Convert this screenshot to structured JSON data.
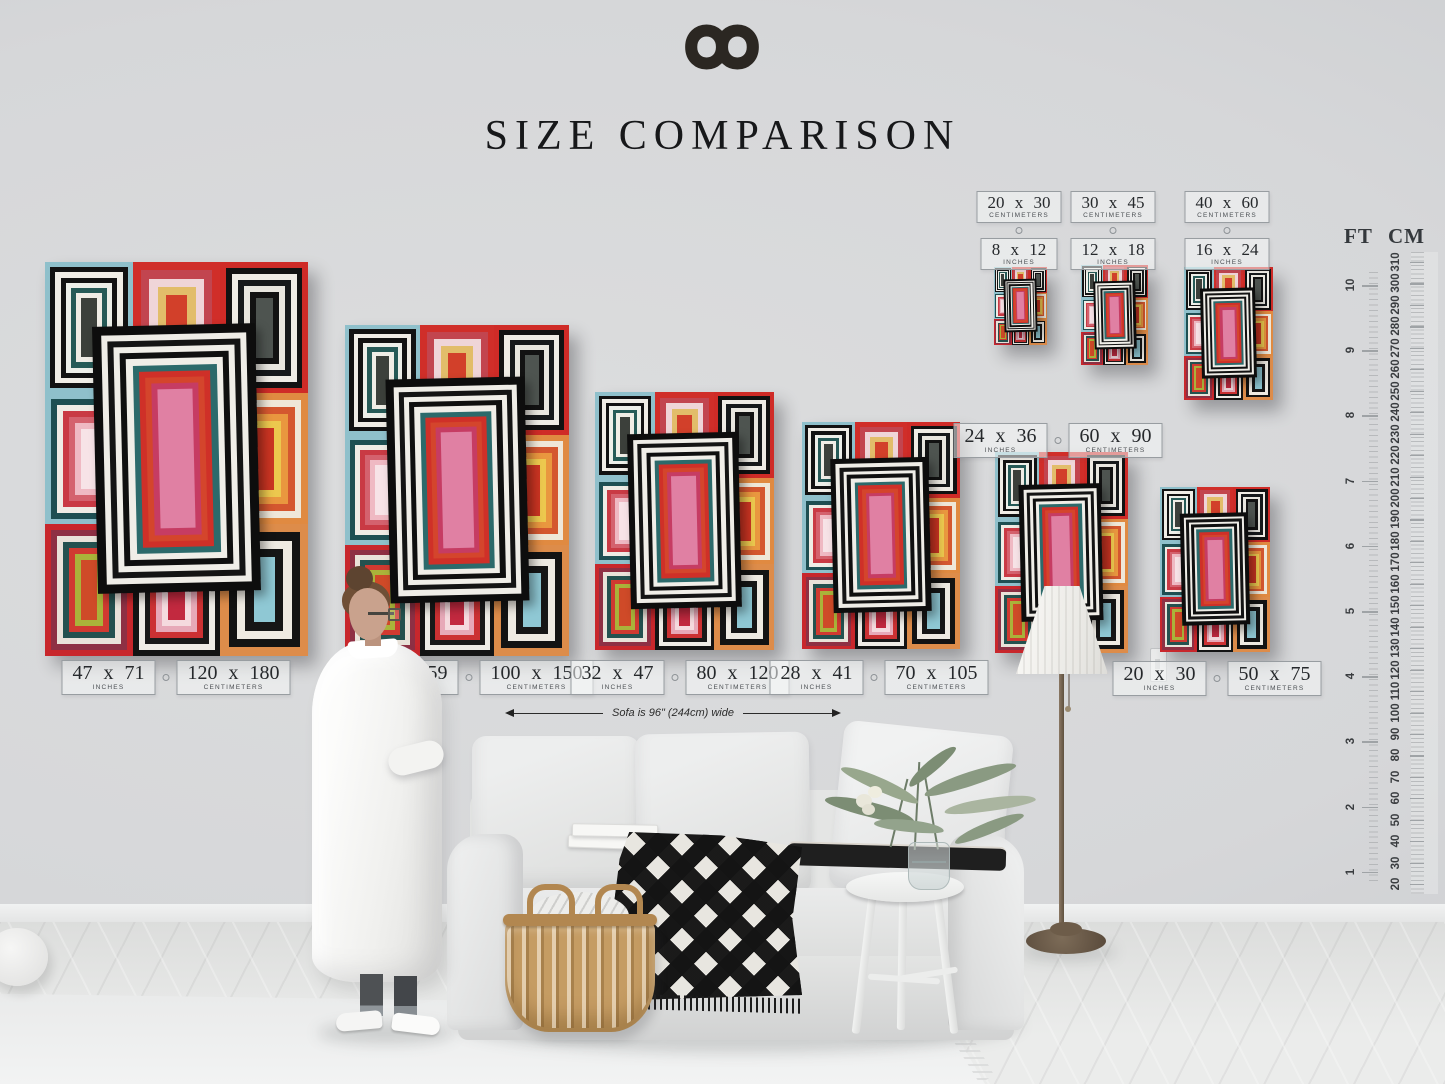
{
  "header": {
    "logo_icon": "infinity-icon",
    "title": "SIZE COMPARISON"
  },
  "annotation": {
    "sofa_width_note": "Sofa is 96\" (244cm) wide"
  },
  "units": {
    "inches": "INCHES",
    "centimeters": "CENTIMETERS"
  },
  "ruler": {
    "ft_header": "FT",
    "cm_header": "CM",
    "ft_marks": [
      10,
      9,
      8,
      7,
      6,
      5,
      4,
      3,
      2,
      1
    ],
    "cm_marks": [
      310,
      300,
      290,
      280,
      270,
      260,
      250,
      240,
      230,
      220,
      210,
      200,
      190,
      180,
      170,
      160,
      150,
      140,
      130,
      120,
      110,
      100,
      90,
      80,
      70,
      60,
      50,
      40,
      30,
      20
    ]
  },
  "size_labels_bottom": [
    {
      "inches": "47 x 71",
      "cm": "120 x 180"
    },
    {
      "inches": "40 x 59",
      "cm": "100 x 150"
    },
    {
      "inches": "32 x 47",
      "cm": "80 x 120"
    },
    {
      "inches": "28 x 41",
      "cm": "70 x 105"
    },
    {
      "inches": "24 x 36",
      "cm": "60 x 90"
    },
    {
      "inches": "20 x 30",
      "cm": "50 x 75"
    }
  ],
  "size_labels_top": [
    {
      "cm": "20 x 30",
      "inches": "8 x 12"
    },
    {
      "cm": "30 x 45",
      "inches": "12 x 18"
    },
    {
      "cm": "40 x 60",
      "inches": "16 x 24"
    }
  ],
  "artwork": {
    "title": "abstract concentric rectangles art print",
    "palette": {
      "red": "#cf2b27",
      "black": "#121212",
      "white": "#efece5",
      "teal": "#2a6b6b",
      "light_blue": "#8fc0cb",
      "orange": "#e08a41",
      "yellow": "#ecc84e",
      "pink": "#e7a9b8",
      "magenta": "#c63c63"
    },
    "cells": [
      [
        "#8fc0cb",
        "#121212",
        "#f0ede6",
        "#121212",
        "#edefe9",
        "#265a57",
        "#f0ede6",
        "#3c403b"
      ],
      [
        "#d02e29",
        "#c2454f",
        "#efd5d8",
        "#e2bd6a",
        "#d2402a"
      ],
      [
        "#cf2b27",
        "#121212",
        "#efece5",
        "#16191b",
        "#e8e6df",
        "#121212",
        "#4e5450"
      ],
      [
        "#8fc0cb",
        "#1e4f52",
        "#efece5",
        "#c93a44",
        "#d4626e",
        "#efb9c3",
        "#f7e3e7"
      ],
      [
        "#cf2b27",
        "#265a57",
        "#cf2b27"
      ],
      [
        "#e08a41",
        "#efe7d8",
        "#d4572f",
        "#e9973f",
        "#ecc84e",
        "#ca3422"
      ],
      [
        "#c8272c",
        "#8e3044",
        "#e9e2d9",
        "#24514f",
        "#d03a31",
        "#aab33a",
        "#cf4a28"
      ],
      [
        "#141414",
        "#efece6",
        "#191919",
        "#cc3133",
        "#e7a9b8",
        "#f5dade",
        "#c2293f"
      ],
      [
        "#dd8c4a",
        "#131313",
        "#eeeae2",
        "#161616",
        "#8fc8d4"
      ]
    ],
    "center_motif": [
      "#0d0d0d",
      "#efede7",
      "#141414",
      "#f0eee8",
      "#0f0f0f",
      "#f0eee8",
      "#2c6a6b",
      "#cf3028",
      "#d4452c",
      "#c63c63",
      "#e080a3"
    ]
  }
}
